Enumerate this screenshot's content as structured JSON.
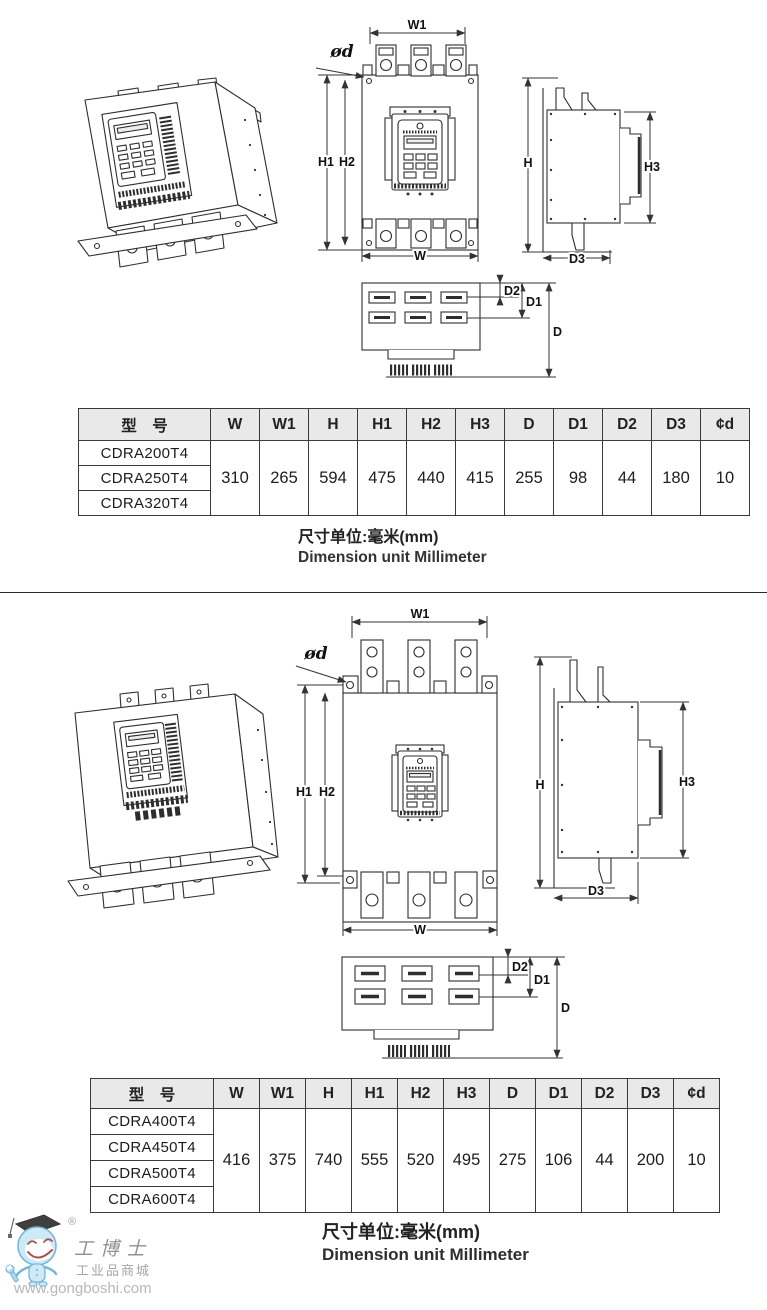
{
  "dims": {
    "w": "W",
    "w1": "W1",
    "h": "H",
    "h1": "H1",
    "h2": "H2",
    "h3": "H3",
    "d": "D",
    "d1": "D1",
    "d2": "D2",
    "d3": "D3",
    "phid": "ød"
  },
  "section1": {
    "table": {
      "model_header": "型　号",
      "headers": [
        "W",
        "W1",
        "H",
        "H1",
        "H2",
        "H3",
        "D",
        "D1",
        "D2",
        "D3",
        "¢d"
      ],
      "models": [
        "CDRA200T4",
        "CDRA250T4",
        "CDRA320T4"
      ],
      "values": [
        "310",
        "265",
        "594",
        "475",
        "440",
        "415",
        "255",
        "98",
        "44",
        "180",
        "10"
      ]
    },
    "unit_cn": "尺寸单位:毫米(mm)",
    "unit_en": "Dimension unit Millimeter"
  },
  "section2": {
    "table": {
      "model_header": "型　号",
      "headers": [
        "W",
        "W1",
        "H",
        "H1",
        "H2",
        "H3",
        "D",
        "D1",
        "D2",
        "D3",
        "¢d"
      ],
      "models": [
        "CDRA400T4",
        "CDRA450T4",
        "CDRA500T4",
        "CDRA600T4"
      ],
      "values": [
        "416",
        "375",
        "740",
        "555",
        "520",
        "495",
        "275",
        "106",
        "44",
        "200",
        "10"
      ]
    },
    "unit_cn": "尺寸单位:毫米(mm)",
    "unit_en": "Dimension unit Millimeter"
  },
  "watermark": {
    "registered": "®",
    "brand": "工博士",
    "sub": "工业品商城",
    "url": "www.gongboshi.com"
  },
  "colors": {
    "line": "#2e2e2e",
    "dim_line": "#333333",
    "table_border": "#3a3a3a",
    "table_header_bg": "#e9e9e9",
    "watermark_text": "#9aa0a4"
  }
}
